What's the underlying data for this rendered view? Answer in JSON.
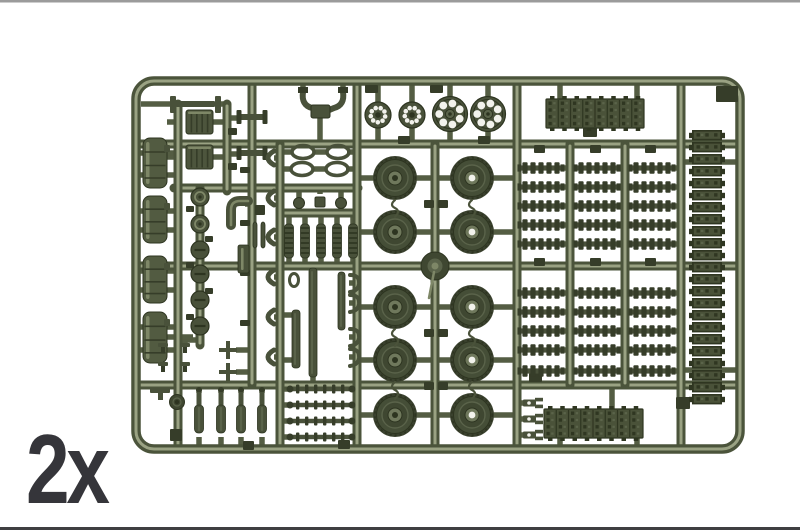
{
  "label": {
    "text": "2x"
  },
  "page": {
    "bg": "#ffffff",
    "border_top": "#9b9b9b",
    "border_bottom": "#3f3f41"
  },
  "colors": {
    "runner_dark": "#4b543b",
    "runner_light": "#9aa283",
    "stub": "#545d43",
    "part": "#49513a",
    "part_dark": "#363d29",
    "part_darker": "#2d3420",
    "part_light": "#7e8767",
    "part_mid": "#5a634a",
    "tank": "#525b41",
    "track_base": "#4a5239",
    "track_dark": "#2f3621",
    "track_mid": "#5b644a",
    "wheel_tire": "#3a412e",
    "wheel_face": "#454e37",
    "wheel_inner": "#3f4731",
    "wheel_hub": "#6f785c",
    "hole_white": "#f2f2ec"
  },
  "frame": {
    "x": 136,
    "y": 81,
    "w": 604,
    "h": 368,
    "rx": 18
  },
  "runners": {
    "h": [
      [
        136,
        740,
        144
      ],
      [
        136,
        740,
        266
      ],
      [
        136,
        740,
        385
      ],
      [
        174,
        358,
        188
      ],
      [
        283,
        357,
        213
      ]
    ],
    "v": [
      [
        178,
        104,
        449
      ],
      [
        227,
        104,
        191
      ],
      [
        252,
        84,
        385
      ],
      [
        280,
        144,
        449
      ],
      [
        357,
        81,
        449
      ],
      [
        435,
        144,
        449
      ],
      [
        517,
        81,
        449
      ],
      [
        570,
        144,
        385
      ],
      [
        625,
        144,
        385
      ],
      [
        681,
        81,
        449
      ],
      [
        200,
        188,
        345
      ]
    ]
  },
  "stubs": [
    [
      378,
      84,
      378,
      103
    ],
    [
      378,
      127,
      378,
      144
    ],
    [
      412,
      84,
      412,
      103
    ],
    [
      412,
      127,
      412,
      144
    ],
    [
      450,
      84,
      450,
      98
    ],
    [
      450,
      131,
      450,
      144
    ],
    [
      488,
      84,
      488,
      98
    ],
    [
      488,
      131,
      488,
      144
    ],
    [
      560,
      84,
      560,
      100
    ],
    [
      637,
      84,
      637,
      100
    ],
    [
      560,
      437,
      560,
      446
    ],
    [
      637,
      437,
      637,
      446
    ],
    [
      612,
      385,
      612,
      410
    ],
    [
      681,
      162,
      737,
      162
    ],
    [
      681,
      266,
      737,
      266
    ],
    [
      681,
      370,
      737,
      370
    ],
    [
      299,
      188,
      299,
      198
    ],
    [
      320,
      188,
      320,
      194
    ],
    [
      341,
      188,
      341,
      198
    ],
    [
      303,
      84,
      303,
      92
    ],
    [
      343,
      84,
      343,
      92
    ],
    [
      320,
      114,
      320,
      144
    ],
    [
      245,
      204,
      252,
      204
    ],
    [
      178,
      188,
      200,
      188
    ],
    [
      177,
      340,
      200,
      340
    ],
    [
      141,
      104,
      170,
      104
    ],
    [
      221,
      104,
      227,
      104
    ],
    [
      227,
      118,
      238,
      118
    ],
    [
      227,
      154,
      238,
      154
    ],
    [
      167,
      122,
      178,
      122
    ],
    [
      167,
      157,
      178,
      157
    ],
    [
      213,
      122,
      227,
      122
    ],
    [
      213,
      157,
      227,
      157
    ],
    [
      236,
      350,
      252,
      350
    ],
    [
      236,
      372,
      252,
      372
    ],
    [
      280,
      315,
      292,
      315
    ],
    [
      280,
      360,
      292,
      360
    ],
    [
      313,
      266,
      313,
      272
    ],
    [
      313,
      376,
      313,
      385
    ],
    [
      280,
      152,
      293,
      152
    ],
    [
      313,
      152,
      328,
      152
    ],
    [
      347,
      152,
      357,
      152
    ],
    [
      280,
      169,
      292,
      169
    ],
    [
      312,
      169,
      327,
      169
    ],
    [
      346,
      169,
      357,
      169
    ],
    [
      517,
      403,
      524,
      403
    ],
    [
      517,
      419,
      524,
      419
    ],
    [
      517,
      435,
      524,
      435
    ],
    [
      177,
      385,
      177,
      395
    ],
    [
      163,
      337,
      163,
      344
    ],
    [
      185,
      337,
      185,
      344
    ],
    [
      152,
      337,
      193,
      337
    ],
    [
      252,
      210,
      256,
      210
    ]
  ],
  "tabs": [
    [
      716,
      86,
      22,
      16
    ],
    [
      365,
      85,
      13,
      8
    ],
    [
      430,
      85,
      13,
      8
    ],
    [
      398,
      136,
      12,
      8
    ],
    [
      478,
      136,
      12,
      8
    ],
    [
      583,
      127,
      14,
      10
    ],
    [
      534,
      145,
      11,
      8
    ],
    [
      590,
      145,
      11,
      8
    ],
    [
      645,
      145,
      11,
      8
    ],
    [
      534,
      258,
      11,
      8
    ],
    [
      590,
      258,
      11,
      8
    ],
    [
      645,
      258,
      11,
      8
    ],
    [
      424,
      200,
      10,
      8
    ],
    [
      438,
      200,
      10,
      8
    ],
    [
      424,
      329,
      10,
      8
    ],
    [
      438,
      329,
      10,
      8
    ],
    [
      424,
      382,
      10,
      8
    ],
    [
      438,
      382,
      10,
      8
    ],
    [
      529,
      373,
      13,
      9
    ],
    [
      676,
      397,
      14,
      12
    ],
    [
      170,
      429,
      12,
      12
    ],
    [
      243,
      441,
      11,
      9
    ],
    [
      338,
      440,
      12,
      9
    ],
    [
      240,
      167,
      10,
      6
    ],
    [
      240,
      220,
      10,
      6
    ],
    [
      240,
      270,
      10,
      6
    ],
    [
      240,
      320,
      10,
      6
    ],
    [
      228,
      128,
      9,
      7
    ],
    [
      228,
      163,
      9,
      7
    ],
    [
      186,
      206,
      8,
      6
    ],
    [
      205,
      236,
      8,
      6
    ],
    [
      186,
      262,
      8,
      6
    ],
    [
      205,
      288,
      8,
      6
    ],
    [
      186,
      314,
      8,
      6
    ],
    [
      255,
      205,
      10,
      10
    ]
  ],
  "sprockets": [
    {
      "cx": 378,
      "cy": 115,
      "r": 13,
      "holes": 9,
      "hole_r": 2.3,
      "ring_r": 7.3,
      "big": false
    },
    {
      "cx": 412,
      "cy": 115,
      "r": 13,
      "holes": 9,
      "hole_r": 2.3,
      "ring_r": 7.3,
      "big": false
    },
    {
      "cx": 450,
      "cy": 114,
      "r": 17.5,
      "holes": 7,
      "hole_r": 3.9,
      "ring_r": 10.8,
      "big": true
    },
    {
      "cx": 488,
      "cy": 114,
      "r": 17.5,
      "holes": 7,
      "hole_r": 3.9,
      "ring_r": 10.8,
      "big": true
    }
  ],
  "road_wheels": {
    "r": 22,
    "rows": [
      178,
      232,
      307,
      360,
      415
    ],
    "cols": [
      {
        "cx": 395,
        "stem_l": 357,
        "stem_r": 435,
        "hole": false
      },
      {
        "cx": 472,
        "stem_l": 435,
        "stem_r": 517,
        "hole": true
      }
    ]
  },
  "boss": {
    "cx": 435,
    "cy": 266
  },
  "squiggles": [
    [
      395,
      200
    ],
    [
      395,
      329
    ],
    [
      395,
      382
    ],
    [
      472,
      200
    ],
    [
      472,
      329
    ],
    [
      472,
      382
    ]
  ],
  "tracks": [
    {
      "x": 546,
      "y": 99,
      "w": 98,
      "h": 29,
      "o": "h"
    },
    {
      "x": 544,
      "y": 409,
      "w": 99,
      "h": 29,
      "o": "h"
    },
    {
      "x": 692,
      "y": 130,
      "w": 30,
      "h": 276,
      "o": "v"
    }
  ],
  "hub_grid": {
    "w": 46,
    "cols": [
      {
        "cx": 541,
        "x1": 517,
        "x2": 570
      },
      {
        "cx": 597,
        "x1": 570,
        "x2": 625
      },
      {
        "cx": 652,
        "x1": 625,
        "x2": 681
      }
    ],
    "rows_top": [
      168,
      187,
      206,
      225,
      244
    ],
    "rows_bottom": [
      293,
      312,
      331,
      350,
      371
    ]
  },
  "fuel_tanks": [
    [
      143,
      138,
      24,
      50
    ],
    [
      143,
      196,
      24,
      47
    ],
    [
      143,
      256,
      24,
      47
    ],
    [
      143,
      312,
      24,
      51
    ]
  ],
  "drums": [
    [
      186,
      110,
      27,
      24
    ],
    [
      186,
      145,
      27,
      24
    ]
  ],
  "axles": [
    [
      252,
      117
    ],
    [
      252,
      153
    ]
  ],
  "discs": {
    "cx": 200,
    "r": 9,
    "items": [
      [
        197,
        "ring"
      ],
      [
        224,
        "ring"
      ],
      [
        250,
        "slot"
      ],
      [
        274,
        "slot"
      ],
      [
        300,
        "slot"
      ],
      [
        326,
        "slot"
      ]
    ]
  },
  "elbow": {
    "d": "M 231 225 L 231 210 Q 231 201 240 201 L 248 201"
  },
  "panel": {
    "x": 238,
    "y": 245,
    "w": 11,
    "h": 28
  },
  "knobs": [
    {
      "type": "ball",
      "cx": 299,
      "cy": 203,
      "r": 5.5
    },
    {
      "type": "sq",
      "x": 315,
      "y": 197,
      "w": 10,
      "h": 10
    },
    {
      "type": "ball",
      "cx": 341,
      "cy": 203,
      "r": 5.5
    }
  ],
  "springs": {
    "xs": [
      289,
      305,
      321,
      337,
      353
    ],
    "y": 224,
    "h": 34
  },
  "loops": [
    [
      303,
      152
    ],
    [
      338,
      152
    ],
    [
      302,
      169
    ],
    [
      337,
      169
    ]
  ],
  "u_yoke": {
    "lx": 303,
    "rx": 343,
    "ty": 92,
    "block": [
      311,
      105,
      19,
      13
    ]
  },
  "i_beam": {
    "lp": [
      170,
      96,
      6,
      17
    ],
    "rp": [
      215,
      96,
      6,
      17
    ],
    "bar": [
      176,
      101,
      39,
      6
    ]
  },
  "c_brackets": {
    "ys": [
      158,
      198,
      237,
      277,
      317,
      357
    ]
  },
  "hooks": {
    "x": 350,
    "ys": [
      283,
      303,
      337,
      357
    ]
  },
  "bars": [
    [
      292,
      310,
      8,
      58
    ],
    [
      309,
      268,
      8,
      109
    ],
    [
      338,
      272,
      7,
      58
    ]
  ],
  "small_bars": [
    [
      253,
      222,
      4,
      26
    ],
    [
      261,
      222,
      4,
      26
    ]
  ],
  "shackle": {
    "cx": 294,
    "cy": 280
  },
  "caps": [
    [
      163,
      343
    ],
    [
      185,
      343
    ],
    [
      163,
      362
    ],
    [
      185,
      362
    ]
  ],
  "crosses": [
    [
      228,
      350
    ],
    [
      228,
      372
    ]
  ],
  "dampers": {
    "xs": [
      199,
      221,
      241,
      262
    ]
  },
  "rods": {
    "x1": 288,
    "x2": 354,
    "ys": [
      389,
      405,
      421,
      437
    ]
  },
  "forks": {
    "x": 523,
    "ys": [
      403,
      419,
      435
    ]
  },
  "wheel_part": {
    "cx": 177,
    "cy": 402,
    "r": 7.5
  },
  "t_bracket": {
    "x": 150,
    "y": 388
  }
}
